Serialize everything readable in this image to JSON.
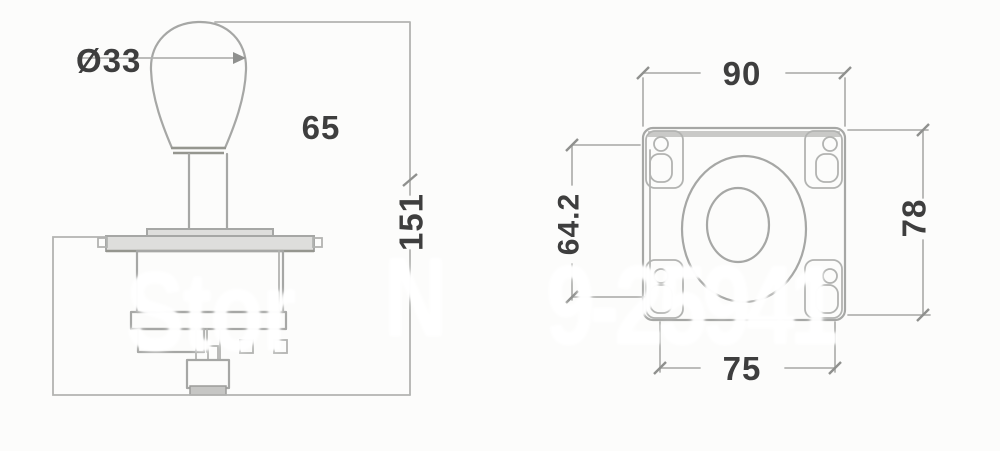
{
  "drawing": {
    "type": "technical-drawing",
    "subject": "arcade-joystick-dimension-drawing",
    "side_view": {
      "ball_diameter": "Ø33",
      "upper_height": "65",
      "total_height": "151"
    },
    "plate_view": {
      "plate_width": "90",
      "plate_height": "78",
      "hole_spacing_vertical": "64.2",
      "hole_spacing_horizontal": "75"
    },
    "watermark": {
      "fragment_left": "Stor",
      "fragment_mid": "N",
      "fragment_right": "9-25941"
    },
    "colors": {
      "background": "#fcfcfb",
      "line": "#a6a7a5",
      "dimension_text": "#3e3e3e",
      "watermark": "#ffffff"
    }
  }
}
